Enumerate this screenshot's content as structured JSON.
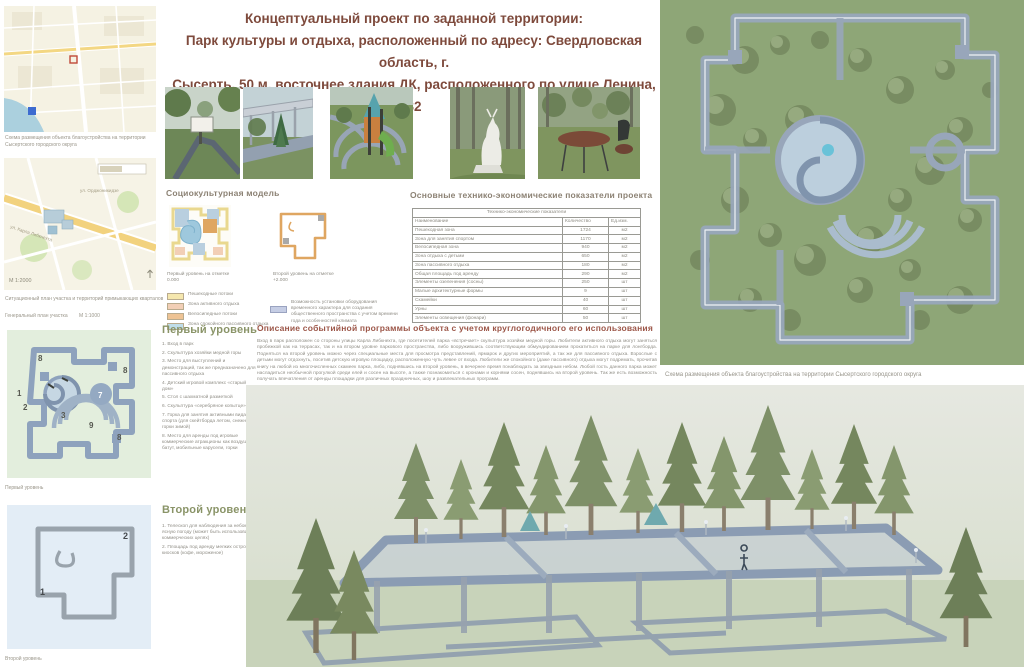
{
  "poster": {
    "title_lines": [
      "Концептуальный проект по заданной территории:",
      "Парк культуры и отдыха, расположенный по адресу: Свердловская область, г.",
      "Сысерть, 50 м. восточнее здания ДК, расположенного по улице Ленина, 32"
    ],
    "accent_title_color": "#7e4a3c",
    "heading_color": "#8c8274"
  },
  "left_column": {
    "map1_caption": "Схема размещения объекта благоустройства на территории Сысертского городского округа",
    "map2_scale": "М 1:2000",
    "map2_street1": "ул. Орджоникидзе",
    "map2_street2": "ул. Карла Либкнехта",
    "map2_caption": "Ситуационный план участка и территорий примыкающих кварталов",
    "genplan_label": "Генеральный план участка",
    "genplan_scale": "М 1:1000",
    "plan1_caption": "Первый уровень",
    "plan2_caption": "Второй уровень",
    "plan1_markers": [
      "1",
      "2",
      "3",
      "7",
      "8",
      "8",
      "8",
      "9"
    ],
    "plan2_markers": [
      "1",
      "2"
    ]
  },
  "sociocultural": {
    "heading": "Социокультурная  модель",
    "level1_label": "Первый уровень на отметке",
    "level1_mark": "0.000",
    "level2_label": "Второй уровень на отметке",
    "level2_mark": "+2.000",
    "legend": [
      {
        "label": "Пешеходные потоки",
        "color": "#f5e7ae"
      },
      {
        "label": "Зона активного отдыха",
        "color": "#f2cfb6"
      },
      {
        "label": "Велосипедные потоки",
        "color": "#eec394"
      },
      {
        "label": "Зона спокойного пассивного отдыха",
        "color": "#bfdde9"
      }
    ],
    "legend2": {
      "label": "Возможность установки оборудования временного характера для создания общественного пространства с учетом времени года и особенностей климата",
      "color": "#c5cde4"
    }
  },
  "tep_table": {
    "heading": "Основные технико-экономические показатели проекта",
    "band": "Технико-экономические показатели",
    "columns": [
      "Наименование",
      "Количество",
      "Ед.изм."
    ],
    "rows": [
      [
        "Пешеходная зона",
        "1724",
        "м2"
      ],
      [
        "Зона для занятия спортом",
        "1170",
        "м2"
      ],
      [
        "Велосипедная зона",
        "940",
        "м2"
      ],
      [
        "Зона отдыха с детьми",
        "650",
        "м2"
      ],
      [
        "Зона пассивного отдыха",
        "180",
        "м2"
      ],
      [
        "Общая площадь под аренду",
        "290",
        "м2"
      ],
      [
        "Элементы озеленения (сосны)",
        "250",
        "шт"
      ],
      [
        "Малые архитектурные формы",
        "9",
        "шт"
      ],
      [
        "Скамейки",
        "40",
        "шт"
      ],
      [
        "Урны",
        "60",
        "шт"
      ],
      [
        "Элементы освещения (фонари)",
        "50",
        "шт"
      ]
    ]
  },
  "description": {
    "heading": "Описание событийной программы объекта с учетом круглогодичного его использования",
    "body": "Вход в парк расположен со стороны улицы Карла Либкнехта, где посетителей парка «встречает» скульптура хозяйки медной горы. Любители активного отдыха могут заняться пробежкой как на террасах, так и на втором уровне паркового пространства, либо вооружившись соответствующим обмундированием прокатиться на парке для лонгборда. Подняться на второй уровень можно через специальные места для просмотра представлений, ярмарок и других мероприятий, а так же для пассивного отдыха. Взрослые с детьми могут отдохнуть, посетив детскую игровую площадку, расположенную чуть левее от входа. Любители же спокойного (даже пассивного) отдыха могут подремать, прочитав книгу на любой из многочисленных скамеек парка, либо, поднявшись на второй уровень, в вечернее время понаблюдать за звездным небом. Любой гость данного парка может насладиться необычной прогулкой среди елей и сосен на высоте, а также познакомиться с кронами и корнями сосен, поднявшись на второй уровень. Так же есть возможность получать впечатления от аренды площадки для различных праздничных, шоу и развлекательных программ."
  },
  "level1_list": {
    "heading": "Первый уровень",
    "items": [
      "1. Вход в парк",
      "2. Скульптура хозяйки медной горы",
      "3. Место для выступлений и демонстраций, так же предназначено для пассивного отдыха",
      "4. Детский игровой комплекс «старый дом»",
      "5. Стол с шахматной разметкой",
      "6. Скульптура «серебряное копытце»",
      "7. Горка для занятия активными видами спорта (для скейтборда летом, снежной горки зимой)",
      "8. Место для аренды под игровые коммерческие атракционы как воздушный батут, мобильные карусели, горки"
    ]
  },
  "level2_list": {
    "heading": "Второй уровень",
    "items": [
      "1. Телескоп для наблюдения за небом в ясную погоду (может быть использован в коммерческих целях)",
      "2. Площадь под аренду мелких островков киосков (кофе, мороженое)"
    ]
  },
  "right_column": {
    "aerial_caption": "Схема размещения объекта благоустройства на территории Сысертского городского округа",
    "plan_path_color": "#98a6ba",
    "grass_color": "#8ea677"
  }
}
